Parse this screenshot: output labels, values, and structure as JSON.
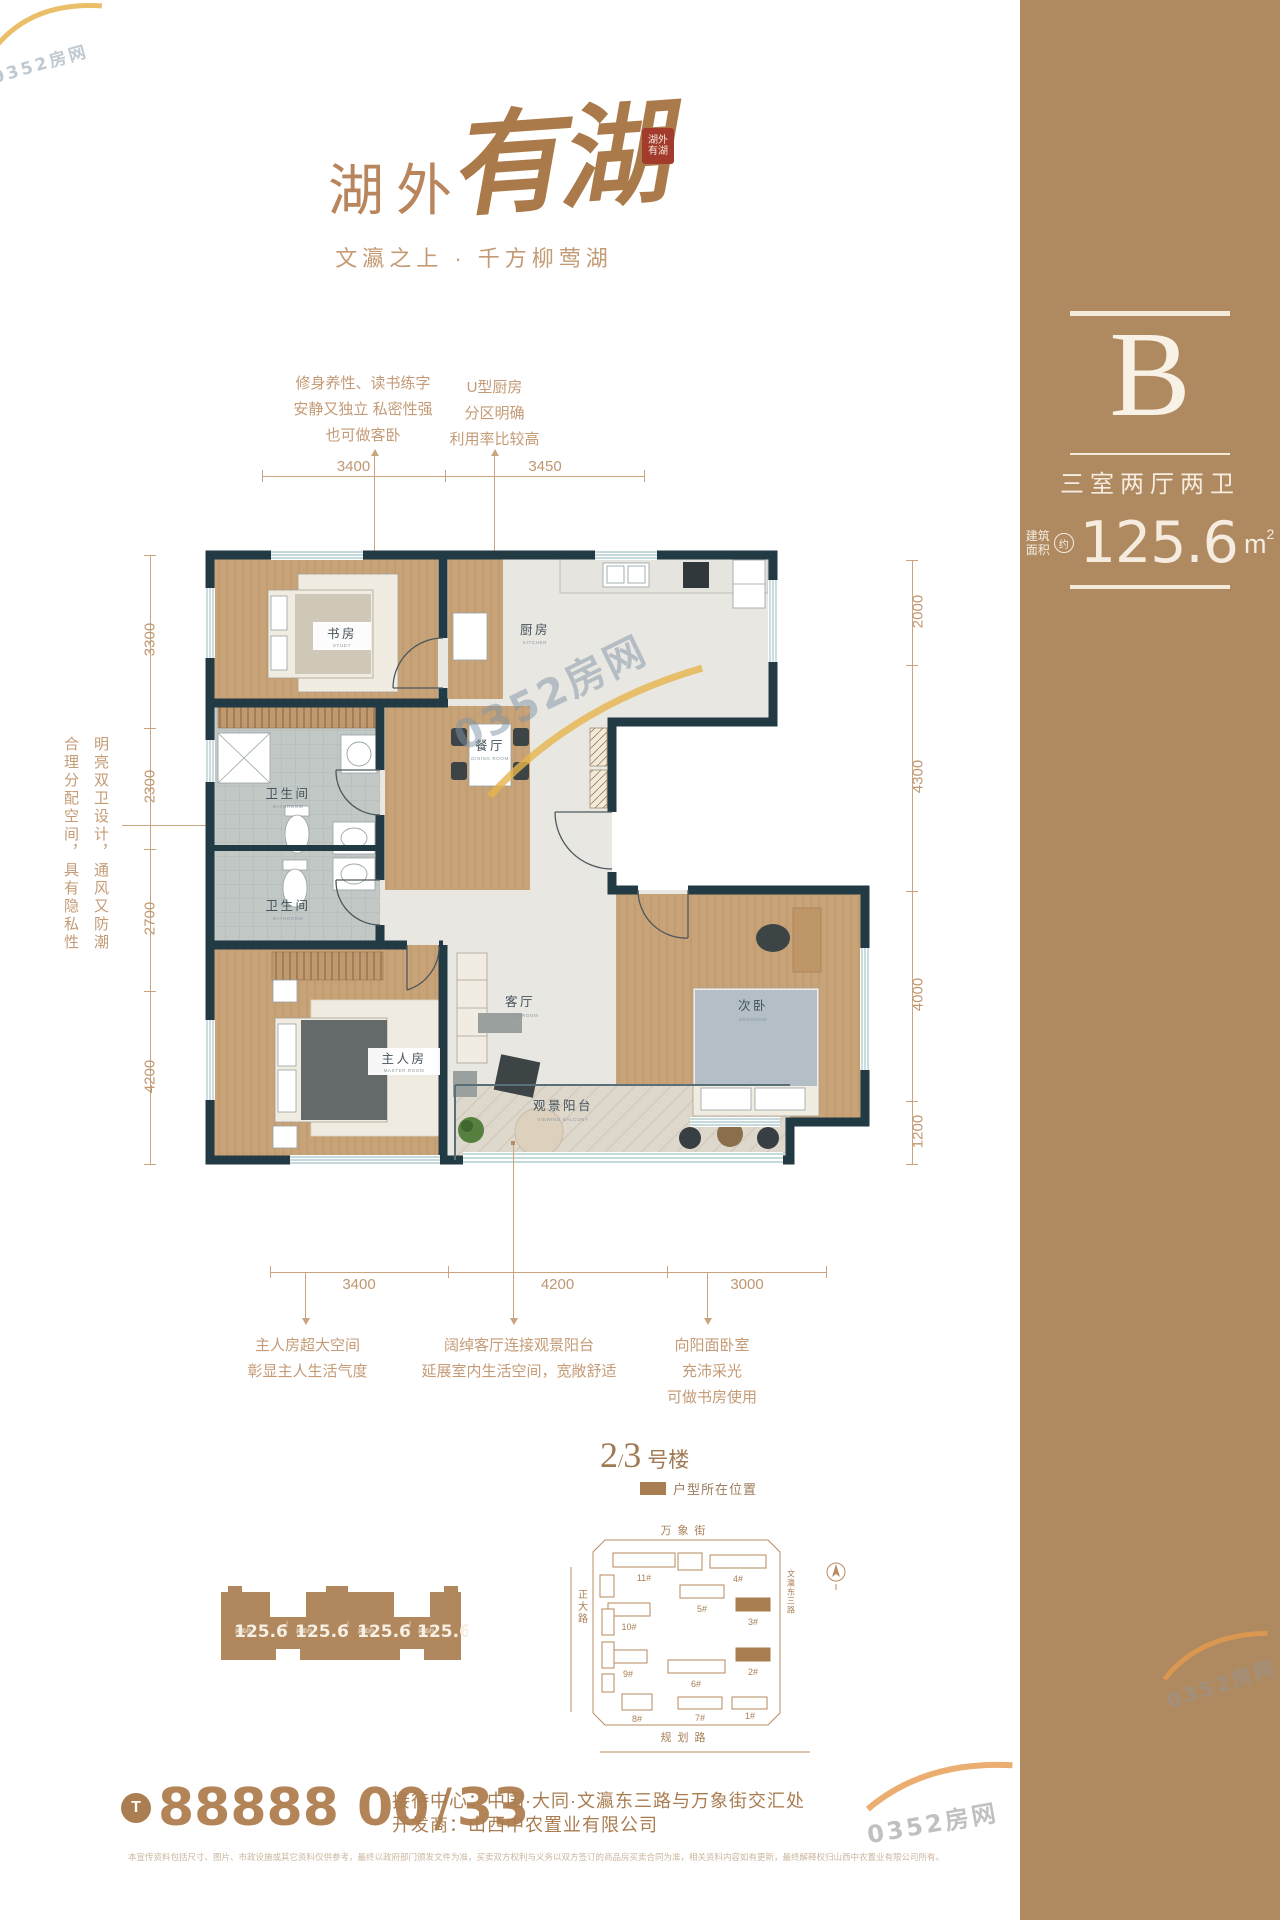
{
  "brand": {
    "logo_main": "湖外",
    "logo_script": "有湖",
    "seal": "湖外有湖",
    "tagline": "文瀛之上 · 千方柳莺湖"
  },
  "unit_panel": {
    "letter": "B",
    "layout_name": "三室两厅两卫",
    "area_label_top": "建筑",
    "area_label_bottom": "面积",
    "area_approx": "约",
    "area_value": "125.6",
    "area_unit": "m",
    "area_exp": "2"
  },
  "callouts": {
    "study": {
      "line1": "修身养性、读书练字",
      "line2": "安静又独立 私密性强",
      "line3": "也可做客卧"
    },
    "kitchen": {
      "line1": "U型厨房",
      "line2": "分区明确",
      "line3": "利用率比较高"
    },
    "baths": {
      "col_left": "合理分配空间，具有隐私性",
      "col_right": "明亮双卫设计，通风又防潮"
    },
    "master": {
      "line1": "主人房超大空间",
      "line2": "彰显主人生活气度"
    },
    "living": {
      "line1": "阔绰客厅连接观景阳台",
      "line2": "延展室内生活空间，宽敞舒适"
    },
    "bedroom": {
      "line1": "向阳面卧室",
      "line2": "充沛采光",
      "line3": "可做书房使用"
    }
  },
  "rooms": {
    "study": "书房",
    "study_sub": "STUDY",
    "kitchen": "厨房",
    "kitchen_sub": "KITCHEN",
    "dining": "餐厅",
    "dining_sub": "DINING ROOM",
    "bath": "卫生间",
    "bath_sub": "BATHROOM",
    "master": "主人房",
    "master_sub": "MASTER ROOM",
    "living": "客厅",
    "living_sub": "LIVING ROOM",
    "bedroom": "次卧",
    "bedroom_sub": "BEDROOM",
    "balcony": "观景阳台",
    "balcony_sub": "VIEWING BALCONY"
  },
  "dims": {
    "top": [
      "3400",
      "3450"
    ],
    "left": [
      "3300",
      "2300",
      "2700",
      "4200"
    ],
    "right": [
      "2000",
      "4300",
      "4000",
      "1200"
    ],
    "bottom": [
      "3400",
      "4200",
      "3000"
    ]
  },
  "location_block": {
    "num1": "2",
    "slash": "/",
    "num2": "3",
    "suffix": "号楼",
    "legend": "户型所在位置",
    "streets": {
      "top": "万象街",
      "left": "正大路",
      "bottom": "规划路",
      "right": "文瀛东三路"
    },
    "buildings": [
      {
        "label": "11#"
      },
      {
        "label": "4#"
      },
      {
        "label": "5#"
      },
      {
        "label": "3#"
      },
      {
        "label": "10#"
      },
      {
        "label": "9#"
      },
      {
        "label": "6#"
      },
      {
        "label": "2#"
      },
      {
        "label": "8#"
      },
      {
        "label": "7#"
      },
      {
        "label": "1#"
      }
    ]
  },
  "footprint": {
    "prefix": "建面约",
    "area": "125.6",
    "unit": "㎡"
  },
  "contact": {
    "phone_icon": "T",
    "phone_main": "88888 00",
    "phone_slash": "/",
    "phone_ext": "33",
    "reception": "接待中心：中国·大同·文瀛东三路与万象街交汇处",
    "developer": "开发商：山西中农置业有限公司"
  },
  "disclaimer": "本宣传资料包括尺寸、图片、市政设施或其它资料仅供参考，最终以政府部门颁发文件为准，买卖双方权利与义务以双方签订的商品房买卖合同为准，相关资料内容如有更新，最终解释权归山西中农置业有限公司所有。",
  "watermark": {
    "text": "0352房网"
  },
  "colors": {
    "accent_brown": "#af8a61",
    "wall": "#223a43",
    "annotation": "#c49b76",
    "seal_red": "#a23b2c"
  }
}
